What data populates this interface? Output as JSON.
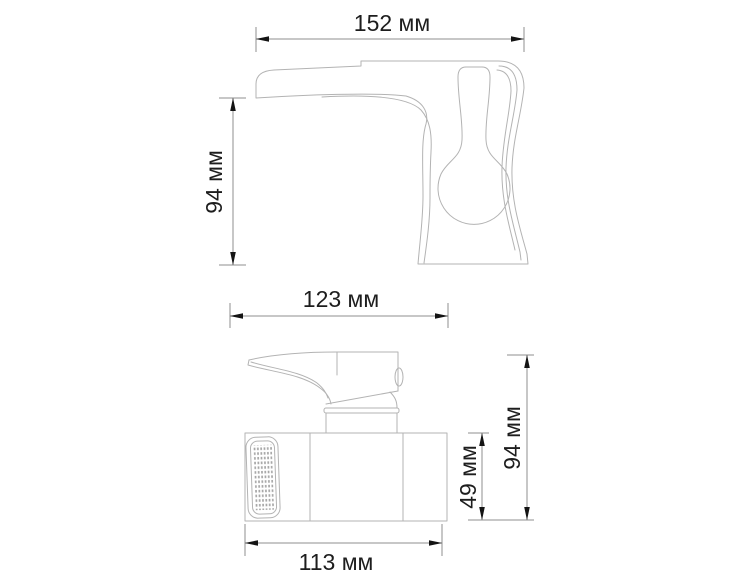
{
  "drawing": {
    "unit": "мм",
    "view_count": 2
  },
  "colors": {
    "background": "#ffffff",
    "outline": "#b3b3b3",
    "dimension_line": "#8f8f8f",
    "arrow": "#141414",
    "text": "#1d1d1d",
    "grid_dot": "#a6a6a6"
  },
  "dimensions": {
    "side_view": {
      "width": {
        "label": "152 мм",
        "value": 152,
        "unit": "мм"
      },
      "height": {
        "label": "94 мм",
        "value": 94,
        "unit": "мм"
      }
    },
    "front_view": {
      "depth": {
        "label": "123 мм",
        "value": 123,
        "unit": "мм"
      },
      "base_width": {
        "label": "113 мм",
        "value": 113,
        "unit": "мм"
      },
      "body_height": {
        "label": "49 мм",
        "value": 49,
        "unit": "мм"
      },
      "overall_height": {
        "label": "94 мм",
        "value": 94,
        "unit": "мм"
      }
    }
  }
}
